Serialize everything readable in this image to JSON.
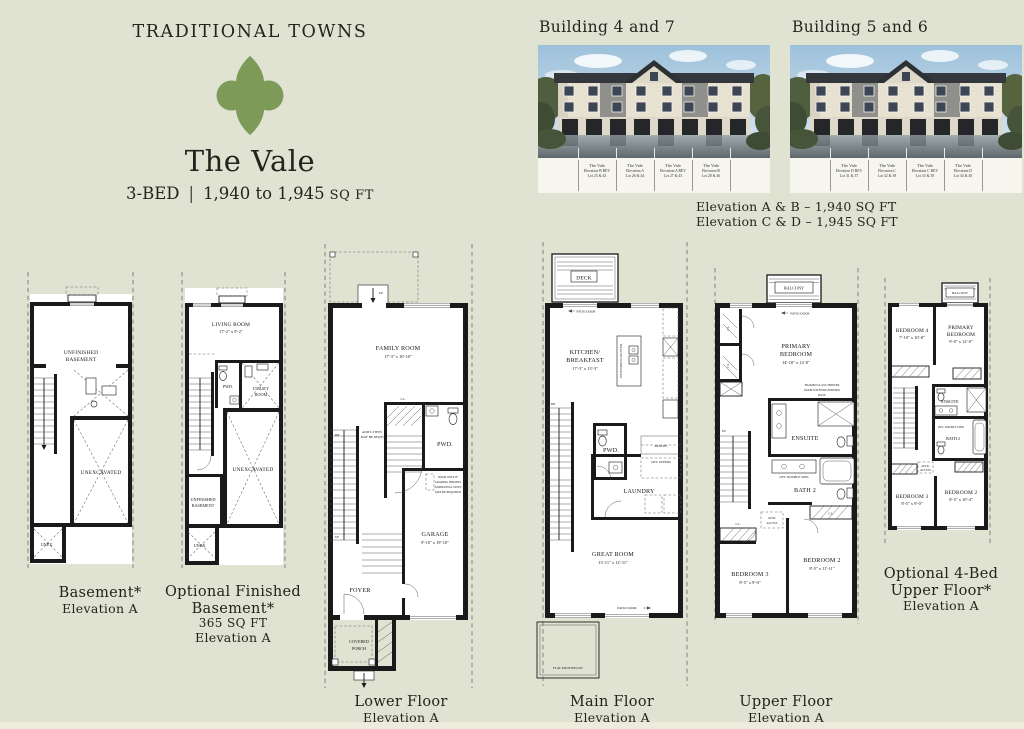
{
  "header": {
    "brand": "TRADITIONAL TOWNS",
    "plan_name": "The Vale",
    "beds": "3-BED",
    "divider": "|",
    "sqft_range": "1,940 to 1,945",
    "sqft_unit": "SQ FT",
    "logo_color": "#7d9a58"
  },
  "buildings": [
    {
      "title": "Building 4 and 7",
      "units": [
        {
          "name": "The Vale",
          "elevation": "Elevation B REV",
          "lot": "Lot 25 & 43"
        },
        {
          "name": "The Vale",
          "elevation": "Elevation A",
          "lot": "Lot 26 & 44"
        },
        {
          "name": "The Vale",
          "elevation": "Elevation A REV",
          "lot": "Lot 27 & 45"
        },
        {
          "name": "The Vale",
          "elevation": "Elevation B",
          "lot": "Lot 28 & 46"
        }
      ]
    },
    {
      "title": "Building 5 and 6",
      "units": [
        {
          "name": "The Vale",
          "elevation": "Elevation D REV",
          "lot": "Lot 31 & 37"
        },
        {
          "name": "The Vale",
          "elevation": "Elevation C",
          "lot": "Lot 32 & 38"
        },
        {
          "name": "The Vale",
          "elevation": "Elevation C REV",
          "lot": "Lot 33 & 39"
        },
        {
          "name": "The Vale",
          "elevation": "Elevation D",
          "lot": "Lot 34 & 40"
        }
      ]
    }
  ],
  "elevation_notes": {
    "line1": "Elevation A & B – 1,940 SQ FT",
    "line2": "Elevation C & D – 1,945 SQ FT"
  },
  "plans": {
    "basement": {
      "caption": [
        "Basement*",
        "Elevation A"
      ],
      "labels": {
        "unfinished": [
          "UNFINISHED",
          "BASEMENT"
        ],
        "unexcavated": "UNEXCAVATED",
        "unex": "UNEX."
      }
    },
    "optional_basement": {
      "caption": [
        "Optional Finished",
        "Basement*",
        "365 SQ FT",
        "Elevation A"
      ],
      "labels": {
        "living": [
          "LIVING ROOM",
          "17'-2\" x 9'-2\""
        ],
        "pwd": "PWD.",
        "utility": [
          "UTILITY",
          "ROOM"
        ],
        "unexcavated": "UNEXCAVATED",
        "unfinished": [
          "UNFINISHED",
          "BASEMENT"
        ],
        "unex": "UNEX."
      }
    },
    "lower": {
      "caption": [
        "Lower Floor",
        "Elevation A"
      ],
      "labels": {
        "family": [
          "FAMILY ROOM",
          "17'-3\" x 10'-10\""
        ],
        "pwd": "PWD.",
        "cl": "CL.",
        "garage": [
          "GARAGE",
          "9'-10\" x 19'-10\""
        ],
        "foyer": "FOYER",
        "porch": [
          "COVERED",
          "PORCH"
        ],
        "up": "UP",
        "dn": "DN",
        "note_steps": [
          "ADD'L STEPS",
          "MAY BE REQ'D"
        ],
        "note_door": [
          "DOOR ONLY IF",
          "GRADING PERMITS",
          "ADDITIONAL STEPS",
          "MAY BE REQUIRED"
        ]
      }
    },
    "main": {
      "caption": [
        "Main Floor",
        "Elevation A"
      ],
      "labels": {
        "deck": "DECK",
        "patio_door": "PATIO DOOR",
        "kitchen": [
          "KITCHEN/",
          "BREAKFAST",
          "17'-3\" x 13'-3\""
        ],
        "extended_counter": "EXTENDED COUNTER",
        "pwd": "PWD.",
        "pantry": "PANTRY",
        "opt_uppers": "OPT. UPPERS",
        "laundry": "LAUNDRY",
        "great": [
          "GREAT ROOM",
          "13'-11\" x 12'-11\""
        ],
        "flat_roof": "FLAT ROOF BELOW",
        "dn": "DN"
      }
    },
    "upper": {
      "caption": [
        "Upper Floor",
        "Elevation A"
      ],
      "labels": {
        "balcony": "BALCONY",
        "patio_door": "PATIO DOOR",
        "primary": [
          "PRIMARY",
          "BEDROOM",
          "14'-10\" x 12'-0\""
        ],
        "ensuite": "ENSUITE",
        "bath2": "BATH 2",
        "opt_sink": "OPT. DOUBLE SINK",
        "shower_note": [
          "FRAMED GLASS SHOWER",
          "DOOR WITH PRE-FORMED",
          "BASE"
        ],
        "attic": [
          "ATTIC",
          "ACCESS"
        ],
        "bed3": [
          "BEDROOM 3",
          "8'-5\" x 9'-0\""
        ],
        "bed2": [
          "BEDROOM 2",
          "8'-5\" x 11'-11\""
        ],
        "cl": "CL.",
        "up": "UP"
      }
    },
    "opt_upper": {
      "caption": [
        "Optional 4-Bed",
        "Upper Floor*",
        "Elevation A"
      ],
      "labels": {
        "balcony": "BALCONY",
        "bed4": [
          "BEDROOM 4",
          "7'-10\" x 10'-8\""
        ],
        "primary": [
          "PRIMARY",
          "BEDROOM",
          "9'-0\" x 12'-0\""
        ],
        "ensuite": "ENSUITE",
        "bath2": "BATH 2",
        "opt_sink": "OPT. DOUBLE SINK",
        "attic": [
          "ATTIC",
          "ACCESS"
        ],
        "bed3": [
          "BEDROOM 3",
          "8'-5\" x 9'-0\""
        ],
        "bed2": [
          "BEDROOM 2",
          "8'-5\" x 10'-4\""
        ],
        "cl": "CL."
      }
    }
  }
}
